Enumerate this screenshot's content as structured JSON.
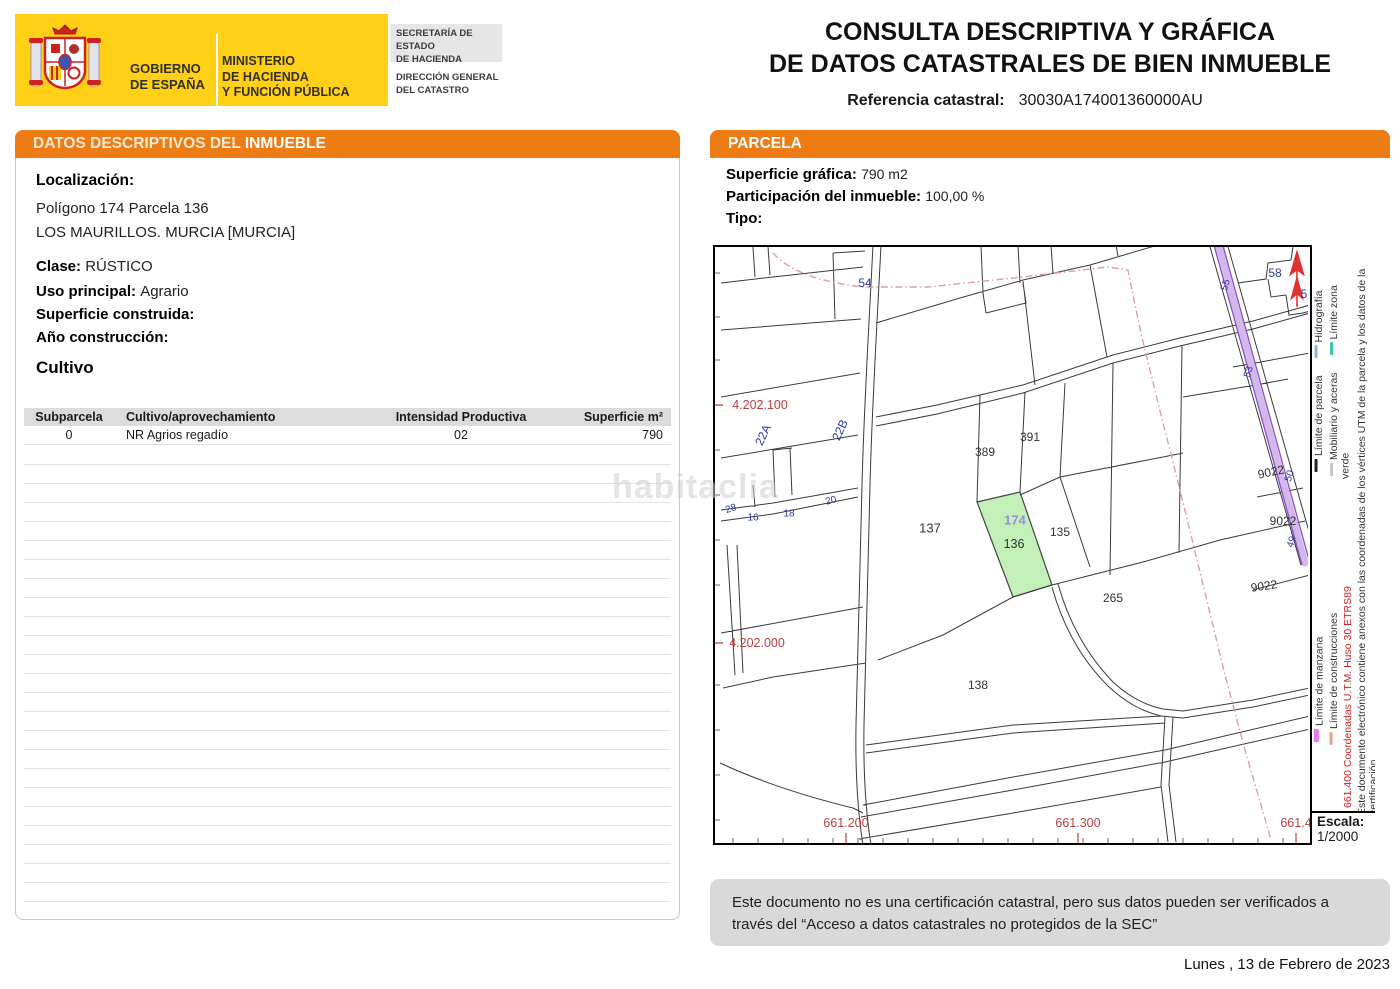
{
  "header": {
    "gobierno": "GOBIERNO\nDE ESPAÑA",
    "ministerio": "MINISTERIO\nDE HACIENDA\nY FUNCIÓN PÚBLICA",
    "secretaria": "SECRETARÍA DE ESTADO\nDE HACIENDA",
    "direccion": "DIRECCIÓN GENERAL\nDEL CATASTRO",
    "title_line1": "CONSULTA DESCRIPTIVA Y GRÁFICA",
    "title_line2": "DE DATOS CATASTRALES DE BIEN INMUEBLE",
    "ref_label": "Referencia catastral:",
    "ref_value": "30030A174001360000AU"
  },
  "inmueble": {
    "header_prefix": "DATOS DESCRIPTIVOS DEL",
    "header_bold": "INMUEBLE",
    "localizacion_label": "Localización:",
    "localizacion_line1": "Polígono 174 Parcela 136",
    "localizacion_line2": "LOS MAURILLOS. MURCIA [MURCIA]",
    "clase_label": "Clase:",
    "clase_value": "RÚSTICO",
    "uso_label": "Uso principal:",
    "uso_value": "Agrario",
    "superficie_label": "Superficie construida:",
    "superficie_value": "",
    "anio_label": "Año construcción:",
    "anio_value": "",
    "cultivo_title": "Cultivo",
    "cultivo_table": {
      "headers": [
        "Subparcela",
        "Cultivo/aprovechamiento",
        "Intensidad Productiva",
        "Superficie m²"
      ],
      "rows": [
        [
          "0",
          "NR Agrios regadío",
          "02",
          "790"
        ]
      ]
    }
  },
  "parcela": {
    "header": "PARCELA",
    "superficie_label": "Superficie gráfica:",
    "superficie_value": "790 m2",
    "participacion_label": "Participación del inmueble:",
    "participacion_value": "100,00 %",
    "tipo_label": "Tipo:",
    "tipo_value": ""
  },
  "map": {
    "parcel_numbers": {
      "p54": "54",
      "p389": "389",
      "p391": "391",
      "p137": "137",
      "p174": "174",
      "p136": "136",
      "p135": "135",
      "p265": "265",
      "p138": "138",
      "p9022a": "9022",
      "p9022b": "9022",
      "p9022c": "9022",
      "p58": "58",
      "p5": "5"
    },
    "street_numbers": {
      "n55": "55",
      "n53": "53",
      "n50": "50",
      "n49": "49",
      "n28": "28",
      "n16": "16",
      "n18": "18",
      "n20": "20",
      "n22A": "22A",
      "n22B": "22B"
    },
    "coords": {
      "y_4202100": "4.202.100",
      "y_4202000": "4.202.000",
      "x_661200": "661.200",
      "x_661300": "661.300",
      "x_6614": "661.4"
    },
    "legend": {
      "limite_parcela": "Límite de parcela",
      "hidrografia": "Hidrografía",
      "mobiliario": "Mobiliario y aceras",
      "zona_verde": "Límite zona verde",
      "limite_manzana": "Límite de manzana",
      "limite_construcciones": "Límite de construcciones",
      "coordenadas": "661.400 Coordenadas U.T.M. Huso 30 ETRS89",
      "nota": "Este documento electrónico contiene anexos con las coordenadas de los vértices UTM de la parcela y los datos de la certificación.",
      "escala_label": "Escala:",
      "escala_value": "1/2000"
    },
    "colors": {
      "selected_parcel_fill": "#c2f0b8",
      "road_fill": "#d4b8ea",
      "road_edge": "#8a4fc8",
      "boundary_red": "#dca0a0",
      "label_blue": "#2b3a9e",
      "coord_red": "#b84040"
    }
  },
  "footer": {
    "disclaimer": "Este documento no es una certificación catastral, pero sus datos pueden ser verificados a través del “Acceso a datos catastrales no protegidos de la SEC”",
    "date": "Lunes , 13 de Febrero de 2023"
  },
  "watermark": "habitaclia",
  "theme": {
    "accent_orange": "#EE7C15",
    "logo_yellow": "#FFD015"
  }
}
